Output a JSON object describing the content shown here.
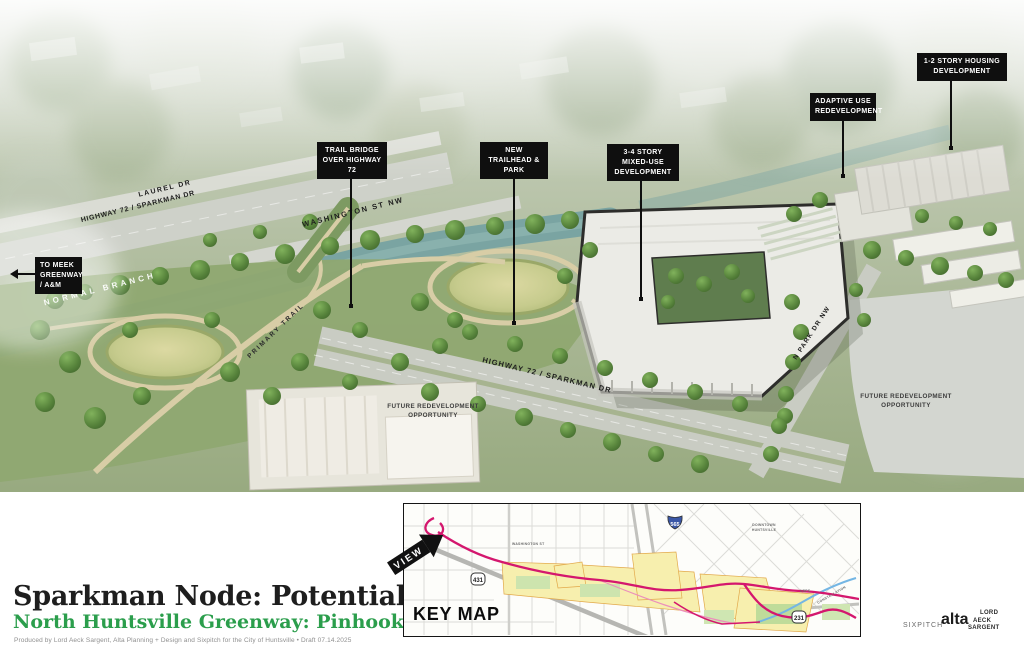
{
  "render": {
    "callouts": {
      "trail_bridge": "TRAIL BRIDGE OVER HIGHWAY 72",
      "new_trailhead": "NEW TRAILHEAD & PARK",
      "mixed_use": "3-4 STORY MIXED-USE DEVELOPMENT",
      "adaptive_use": "ADAPTIVE USE REDEVELOPMENT",
      "housing": "1-2 STORY HOUSING DEVELOPMENT",
      "to_meek": "TO MEEK GREENWAY / A&M"
    },
    "road_labels": {
      "laurel": "LAUREL DR",
      "hwy72_upper": "HIGHWAY 72 / SPARKMAN DR",
      "washington": "WASHINGTON ST NW",
      "normal_branch": "NORMAL BRANCH",
      "primary_trail": "PRIMARY TRAIL",
      "hwy72_main": "HIGHWAY 72 / SPARKMAN DR",
      "n_park_dr": "N PARK DR NW"
    },
    "area_labels": {
      "future_center": "FUTURE REDEVELOPMENT OPPORTUNITY",
      "future_right": "FUTURE REDEVELOPMENT OPPORTUNITY"
    }
  },
  "titleblock": {
    "title": "Sparkman Node: Potential",
    "subtitle": "North Huntsville Greenway: Pinhook Segment",
    "subtitle_color": "#2b9e4c",
    "credit": "Produced by Lord Aeck Sargent, Alta Planning + Design and Sixpitch for the City of Huntsville  •  Draft 07.14.2025"
  },
  "keymap": {
    "heading": "KEY MAP",
    "view_label": "VIEW",
    "trail_color": "#d4176e",
    "shields": {
      "s431": "431",
      "s565": "565",
      "s231": "231"
    },
    "micro_labels": {
      "washington": "WASHINGTON ST",
      "downtown_1": "DOWNTOWN",
      "downtown_2": "HUNTSVILLE",
      "usps": "USPS",
      "constellation": "CONSTELLATION"
    }
  },
  "logos": {
    "sixpitch": "SIXPITCH",
    "alta": "alta",
    "las_line1": "LORD",
    "las_line2": "AECK",
    "las_line3": "SARGENT"
  }
}
